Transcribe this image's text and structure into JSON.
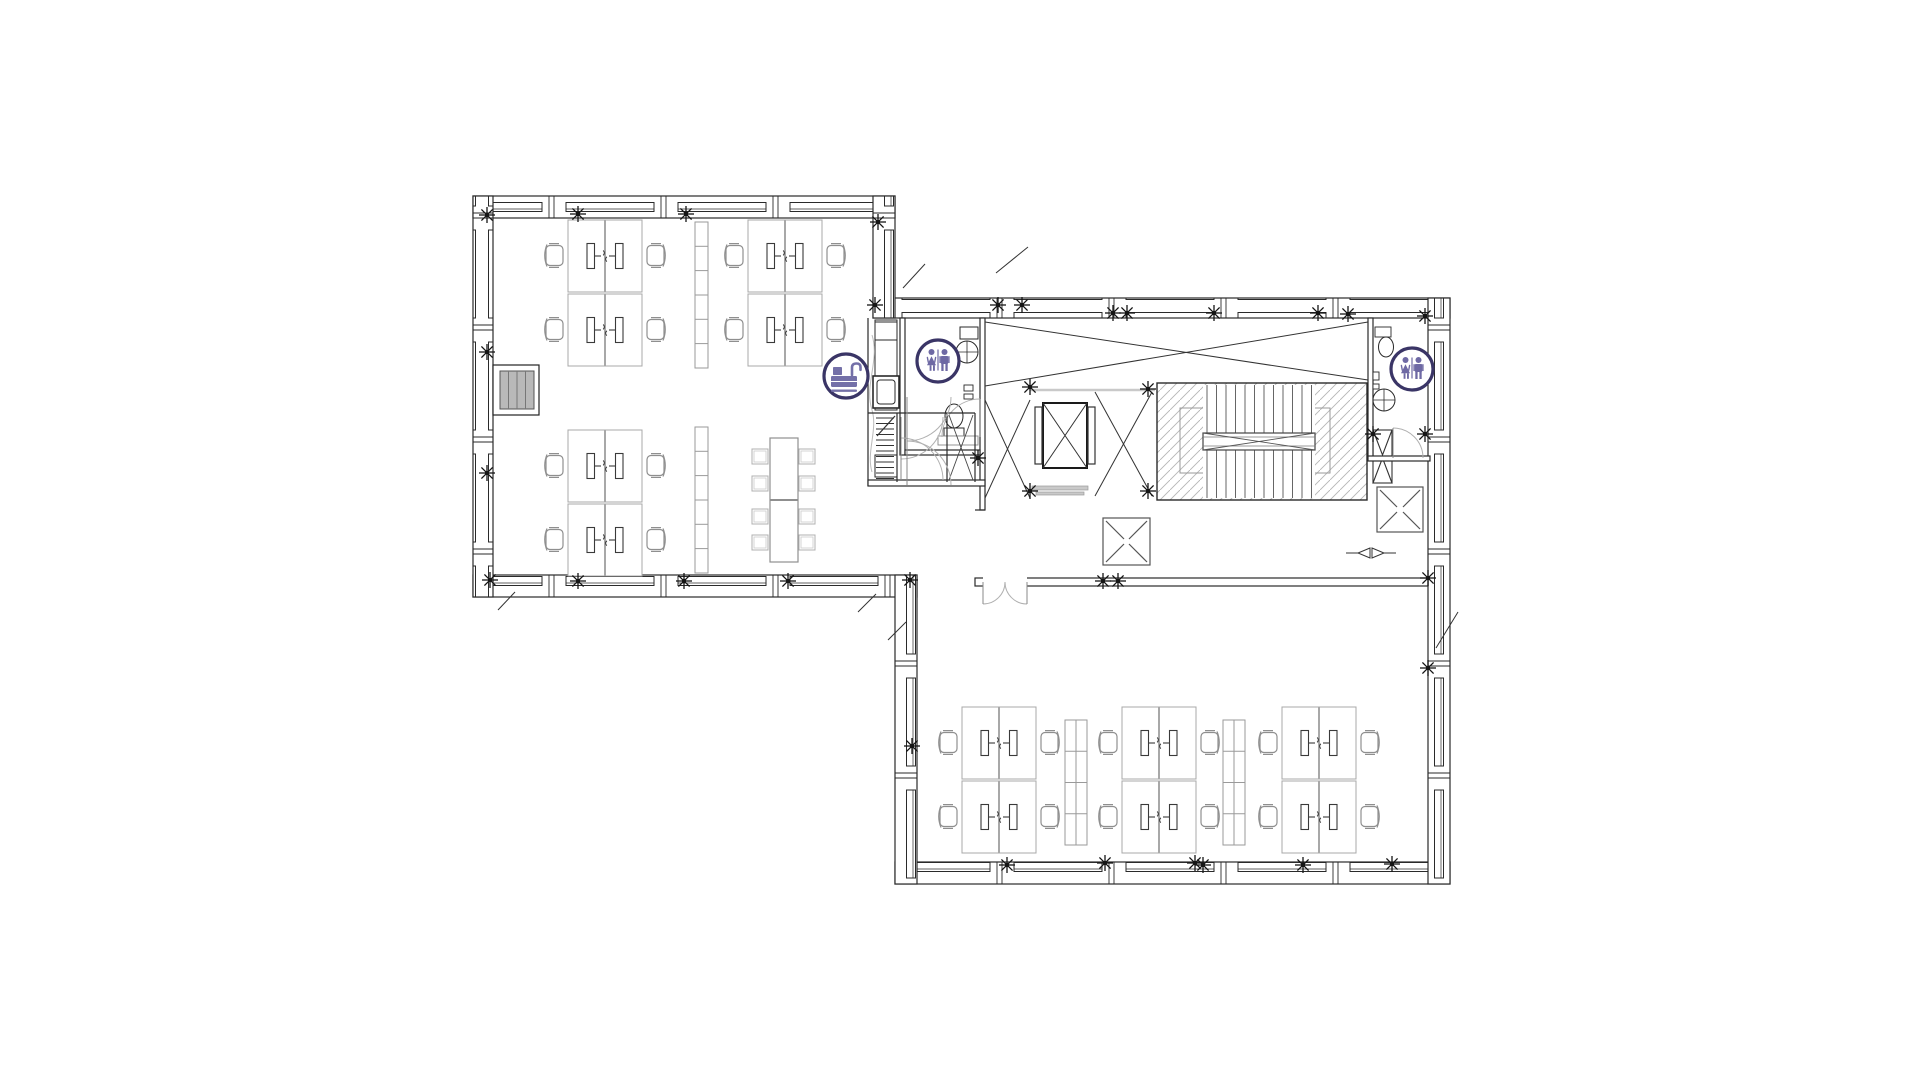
{
  "drawing": {
    "type": "architectural-floor-plan",
    "background": "#ffffff"
  },
  "palette": {
    "wall": "#222222",
    "wall_light": "#555555",
    "furniture": "#a8a8a8",
    "chair": "#8f8f8f",
    "monitor": "#3a3a3a",
    "hatch": "#b5b5b5",
    "gray_fill": "#b9b9b9",
    "sill_gray": "#c9c9c9",
    "door_arc": "#b0b0b0",
    "icon_ring": "#3a3566",
    "icon_glyph": "#7470a8",
    "icon_figures": "#6e69a4"
  },
  "icons": [
    {
      "name": "kitchenette-icon",
      "glyph": "kitchen-sink",
      "cx": 846,
      "cy": 376,
      "r": 22
    },
    {
      "name": "restroom-icon-left",
      "glyph": "wc-figures",
      "cx": 938,
      "cy": 361,
      "r": 21
    },
    {
      "name": "restroom-icon-right",
      "glyph": "wc-figures",
      "cx": 1412,
      "cy": 369,
      "r": 21
    }
  ],
  "furniture": {
    "desk_clusters": [
      {
        "x": 568,
        "y": 220,
        "zone": "left-wing"
      },
      {
        "x": 748,
        "y": 220,
        "zone": "left-wing"
      },
      {
        "x": 568,
        "y": 430,
        "zone": "left-wing"
      },
      {
        "x": 962,
        "y": 707,
        "zone": "bottom-wing"
      },
      {
        "x": 1122,
        "y": 707,
        "zone": "bottom-wing"
      },
      {
        "x": 1282,
        "y": 707,
        "zone": "bottom-wing"
      }
    ],
    "dividers_tall": [
      {
        "x": 695,
        "y": 222
      },
      {
        "x": 695,
        "y": 427
      }
    ],
    "dividers_wide": [
      {
        "x": 1065,
        "y": 720
      },
      {
        "x": 1223,
        "y": 720
      }
    ],
    "meeting_table": {
      "x": 770,
      "y": 438,
      "w": 28,
      "h": 124,
      "chair_w": 16,
      "chair_h": 15,
      "left_chair_x": 752,
      "right_chair_x": 799,
      "chair_ys": [
        449,
        476,
        509,
        535
      ]
    },
    "entry_stair": {
      "x": 493,
      "y": 365,
      "w": 46,
      "h": 50
    }
  },
  "column_markers": [
    [
      487,
      215
    ],
    [
      578,
      214
    ],
    [
      686,
      214
    ],
    [
      487,
      352
    ],
    [
      487,
      473
    ],
    [
      490,
      580
    ],
    [
      578,
      581
    ],
    [
      684,
      581
    ],
    [
      788,
      581
    ],
    [
      878,
      222
    ],
    [
      875,
      305
    ],
    [
      998,
      305
    ],
    [
      1022,
      305
    ],
    [
      1113,
      313
    ],
    [
      1127,
      313
    ],
    [
      1214,
      313
    ],
    [
      1318,
      313
    ],
    [
      1348,
      314
    ],
    [
      1425,
      316
    ],
    [
      1030,
      387
    ],
    [
      1148,
      389
    ],
    [
      1030,
      491
    ],
    [
      1148,
      491
    ],
    [
      978,
      458
    ],
    [
      1103,
      581
    ],
    [
      1118,
      581
    ],
    [
      1373,
      434
    ],
    [
      1425,
      434
    ],
    [
      1428,
      578
    ],
    [
      1428,
      668
    ],
    [
      1007,
      865
    ],
    [
      1105,
      863
    ],
    [
      1195,
      863
    ],
    [
      1203,
      865
    ],
    [
      1303,
      865
    ],
    [
      1392,
      864
    ],
    [
      910,
      580
    ],
    [
      912,
      746
    ]
  ]
}
